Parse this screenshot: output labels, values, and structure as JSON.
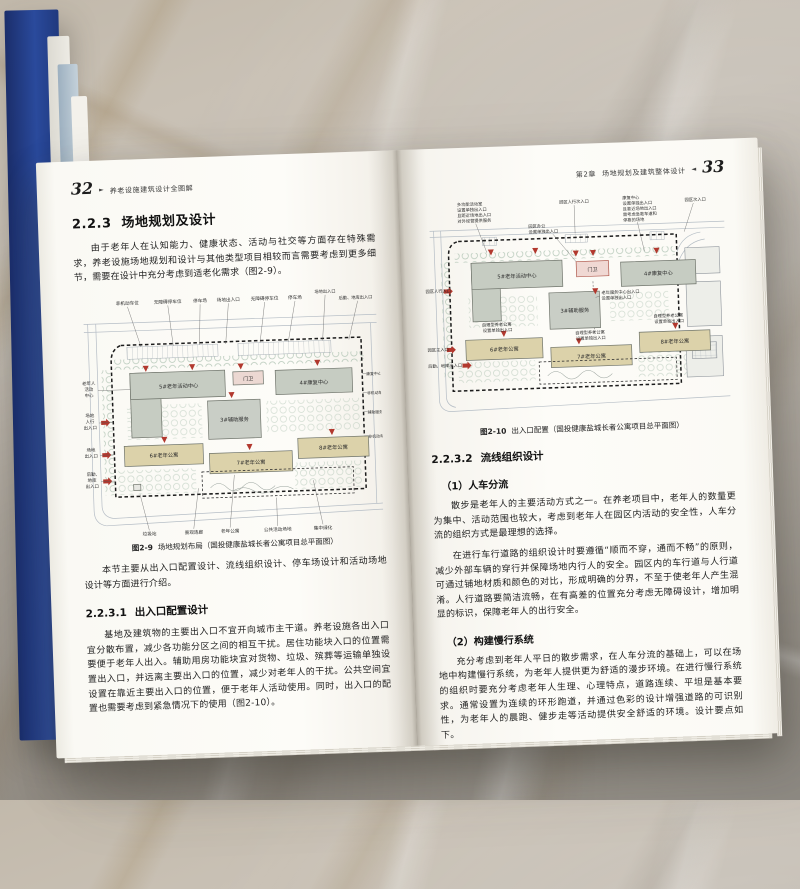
{
  "colors": {
    "cover_navy": "#23408f",
    "sheet_blue": "#b0c0cd",
    "building_green_grey": "#c6ccc2",
    "building_tan": "#dcd2aa",
    "gatehouse_pink": "#ecd8d2",
    "entrance_red": "#b2382e",
    "marble_grey": "#b3aca2"
  },
  "left_page": {
    "page_number": "32",
    "header_marker": "►",
    "book_title": "养老设施建筑设计全图解",
    "section": {
      "number": "2.2.3",
      "title": "场地规划及设计"
    },
    "paragraph_intro": "由于老年人在认知能力、健康状态、活动与社交等方面存在特殊需求，养老设施场地规划和设计与其他类型项目相较而言需要考虑到更多细节，需要在设计中充分考虑到适老化需求（图2-9）。",
    "figure": {
      "caption_label": "图2-9",
      "caption_text": "场地规划布局（国投健康盐城长者公寓项目总平面图）",
      "top_labels": [
        "非机动车位",
        "无障碍停车位",
        "停车场",
        "场地出入口",
        "无障碍停车位",
        "停车场",
        "场地出入口",
        "后勤、地库出入口"
      ],
      "left_labels": [
        [
          "老年人",
          "活动",
          "中心"
        ],
        [
          "场地",
          "人行",
          "出入口"
        ],
        [
          "场地",
          "出入口"
        ],
        [
          "后勤,",
          "地库",
          "出入口"
        ]
      ],
      "right_labels": [
        "康复中心",
        "非机动车位",
        "辅助服务",
        "非机动车位"
      ],
      "bottom_labels": [
        "垃圾站",
        "景观连廊",
        "老年公寓",
        "公共活动场地",
        "集中绿化"
      ],
      "buildings": {
        "b5": "5#老年活动中心",
        "gate": "门卫",
        "b4": "4#康复中心",
        "b3": "3#辅助服务",
        "b6": "6#老年公寓",
        "b7": "7#老年公寓",
        "b8": "8#老年公寓"
      }
    },
    "paragraph_overview": "本节主要从出入口配置设计、流线组织设计、停车场设计和活动场地设计等方面进行介绍。",
    "subsection": {
      "number": "2.2.3.1",
      "title": "出入口配置设计"
    },
    "paragraph_entrance": "基地及建筑物的主要出入口不宜开向城市主干道。养老设施各出入口宜分散布置，减少各功能分区之间的相互干扰。居住功能块入口的位置需要便于老年人出入。辅助用房功能块宜对货物、垃圾、殡葬等运输单独设置出入口，并远离主要出入口的位置，减少对老年人的干扰。公共空间宜设置在靠近主要出入口的位置，便于老年人活动使用。同时，出入口的配置也需要考虑到紧急情况下的使用（图2-10）。"
  },
  "right_page": {
    "chapter_label": "第2章",
    "chapter_title": "场地规划及建筑整体设计",
    "header_marker": "◄",
    "page_number": "33",
    "figure": {
      "caption_label": "图2-10",
      "caption_text": "出入口配置（国投健康盐城长者公寓项目总平面图）",
      "ann_multi_activity": [
        "多功能活动室",
        "设置单独出入口",
        "且距近场地出入口",
        "对外经营提供服务"
      ],
      "ann_ped_secondary": "园区人行次入口",
      "ann_rehab": [
        "康复中心",
        "设置单独出入口",
        "且靠近场地出入口",
        "需考虑急救车道和",
        "停靠的场地"
      ],
      "ann_secondary": "园区次入口",
      "ann_office": [
        "园区办公",
        "设置单独出入口"
      ],
      "ann_service": [
        "老年服务中心出入口",
        "设置单独出入口"
      ],
      "ann_selfcare": [
        "自理型养老公寓",
        "设置单独出入口"
      ],
      "ann_ped_main": "园区人行入口",
      "ann_main": "园区主入口",
      "ann_logistics": "后勤、地库出入口",
      "buildings": {
        "b5": "5#老年活动中心",
        "gate": "门卫",
        "b4": "4#康复中心",
        "b3": "3#辅助服务",
        "b6": "6#老年公寓",
        "b7": "7#老年公寓",
        "b8": "8#老年公寓"
      }
    },
    "subsection": {
      "number": "2.2.3.2",
      "title": "流线组织设计"
    },
    "item1_heading": "（1）人车分流",
    "item1_p1": "散步是老年人的主要活动方式之一。在养老项目中，老年人的数量更为集中、活动范围也较大，考虑到老年人在园区内活动的安全性，人车分流的组织方式是最理想的选择。",
    "item1_p2": "在进行车行道路的组织设计时要遵循“顺而不穿，通而不畅”的原则，减少外部车辆的穿行并保障场地内行人的安全。园区内的车行道与人行道可通过铺地材质和颜色的对比，形成明确的分界，不至于使老年人产生混淆。人行道路要简洁流畅，在有高差的位置充分考虑无障碍设计，增加明显的标识，保障老年人的出行安全。",
    "item2_heading": "（2）构建慢行系统",
    "item2_p1": "充分考虑到老年人平日的散步需求，在人车分流的基础上，可以在场地中构建慢行系统，为老年人提供更为舒适的漫步环境。在进行慢行系统的组织时要充分考虑老年人生理、心理特点，道路连续、平坦是基本要求。通常设置为连续的环形跑道，并通过色彩的设计增强道路的可识别性，为老年人的晨跑、健步走等活动提供安全舒适的环境。设计要点如下。"
  }
}
